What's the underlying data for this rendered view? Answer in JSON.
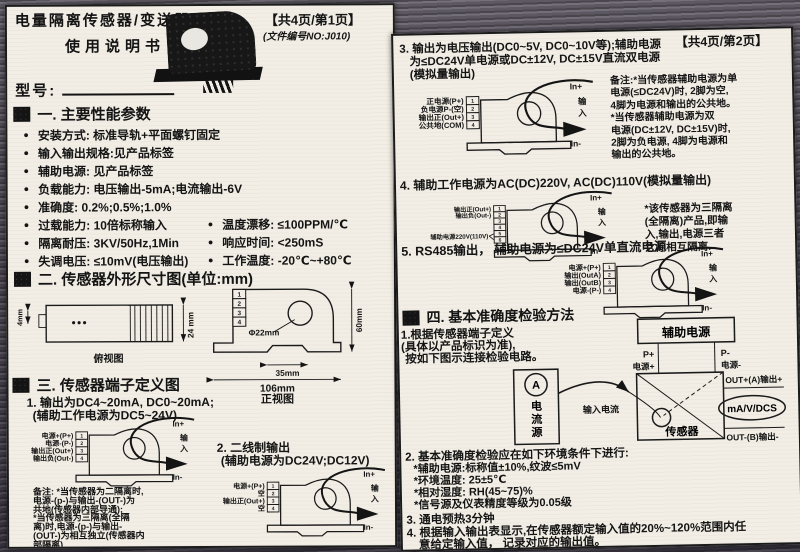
{
  "bullet": "●",
  "terminals4": [
    "1",
    "2",
    "3",
    "4"
  ],
  "terminals6": [
    "1",
    "2",
    "3",
    "4",
    "5",
    "6"
  ],
  "wiring_common": {
    "in_plus": "In+",
    "in_char1": "输",
    "in_char2": "入",
    "in_minus": "In-"
  },
  "page1": {
    "title_line1": "电量隔离传感器/变送器",
    "title_line2": "使用说明书",
    "page_badge": "【共4页/第1页】",
    "doc_no": "(文件编号NO:J010)",
    "model_label": "型号:",
    "section1_title": "一. 主要性能参数",
    "params_single": [
      "安装方式: 标准导轨+平面螺钉固定",
      "输入输出规格:见产品标签",
      "辅助电源: 见产品标签",
      "负载能力: 电压输出-5mA;电流输出-6V",
      "准确度: 0.2%;0.5%;1.0%"
    ],
    "params_double": [
      {
        "left": "过载能力: 10倍标称输入",
        "right": "温度漂移: ≤100PPM/℃"
      },
      {
        "left": "隔离耐压: 3KV/50Hz,1Min",
        "right": "响应时间: <250mS"
      },
      {
        "left": "失调电压: ≤10mV(电压输出)",
        "right": "工作温度: -20℃~+80℃"
      }
    ],
    "section2_title": "二. 传感器外形尺寸图(单位:mm)",
    "dims": {
      "d4": "4mm",
      "d24": "24 mm",
      "side_label": "俯视图",
      "dia": "Φ22mm",
      "w35": "35mm",
      "w106": "106mm",
      "h60": "60mm",
      "front_label": "正视图"
    },
    "section3_title": "三. 传感器端子定义图",
    "item1_line1": "1. 输出为DC4~20mA, DC0~20mA;",
    "item1_line2": "(辅助工作电源为DC5~24V)",
    "diagram1_labels": [
      "电源+(P+)",
      "电源-(P-)",
      "输出正(Out+)",
      "输出负(Out-)"
    ],
    "note1": [
      "备注: *当传感器为二隔离时,",
      "电源-(p-)与输出-(OUT-)为",
      "共地(传感器内部导通);",
      "    *当传感器为三隔离(全隔",
      "离)时,电源-(p-)与输出-",
      "(OUT-)为相互独立(传感器内",
      "部隔离)"
    ],
    "item2_line1": "2. 二线制输出",
    "item2_line2": "(辅助电源为DC24V;DC12V)",
    "diagram2_labels": [
      "电源+(P+)",
      "空",
      "输出正(Out+)",
      "空"
    ]
  },
  "page2": {
    "page_badge": "【共4页/第2页】",
    "item3_line1": "3. 输出为电压输出(DC0~5V, DC0~10V等);辅助电源",
    "item3_line2": "为≤DC24V单电源或DC±12V, DC±15V直流双电源",
    "item3_line3": "(模拟量输出)",
    "diagram3_labels": [
      "正电源(P+)",
      "负电源P-(空)",
      "输出正(Out+)",
      "公共地(COM)"
    ],
    "note3": [
      "备注:*当传感器辅助电源为单",
      "电源(≤DC24V)时, 2脚为空,",
      "4脚为电源和输出的公共地。",
      "    *当传感器辅助电源为双",
      "电源(DC±12V, DC±15V)时,",
      "2脚为负电源, 4脚为电源和",
      "输出的公共地。"
    ],
    "item4": "4. 辅助工作电源为AC(DC)220V, AC(DC)110V(模拟量输出)",
    "diagram4_labels": [
      "输出正(Out+)",
      "输出负(Out-)",
      "辅助电源220V(110V)"
    ],
    "note4": [
      "*该传感器为三隔离",
      "(全隔离)产品,即输",
      "入,输出,电源三者",
      "之间相互隔离."
    ],
    "item5": "5. RS485输出， 辅助电源为≤DC24V单直流电源",
    "diagram5_labels": [
      "电源+(P+)",
      "输出(OutA)",
      "输出(OutB)",
      "电源-(P-)"
    ],
    "section4_title": "四. 基本准确度检验方法",
    "method1_line1": "1.根据传感器端子定义",
    "method1_line2": "(具体以产品标识为准),",
    "method1_line3": "按如下图示连接检验电路。",
    "verify": {
      "aux_power": "辅助电源",
      "p_plus": "P+",
      "p_plus_cn": "电源+",
      "p_minus": "P-",
      "p_minus_cn": "电源-",
      "ammeter": "A",
      "source_c1": "电",
      "source_c2": "流",
      "source_c3": "源",
      "input_current": "输入电流",
      "sensor": "传感器",
      "out_plus": "OUT+(A)输出+",
      "meter": "mA/V/DCS",
      "out_minus": "OUT-(B)输出-"
    },
    "method2": "2. 基本准确度检验应在如下环境条件下进行:",
    "method2_items": [
      "*辅助电源:标称值±10%,纹波≤5mV",
      "*环境温度: 25±5℃",
      "*相对湿度: RH(45~75)%",
      "*信号源及仪表精度等级为0.05级"
    ],
    "method3": "3. 通电预热3分钟",
    "method4_line1": "4. 根据输入输出表显示,在传感器额定输入值的20%~120%范围内任",
    "method4_line2": "意给定输入值， 记录对应的输出值。"
  }
}
